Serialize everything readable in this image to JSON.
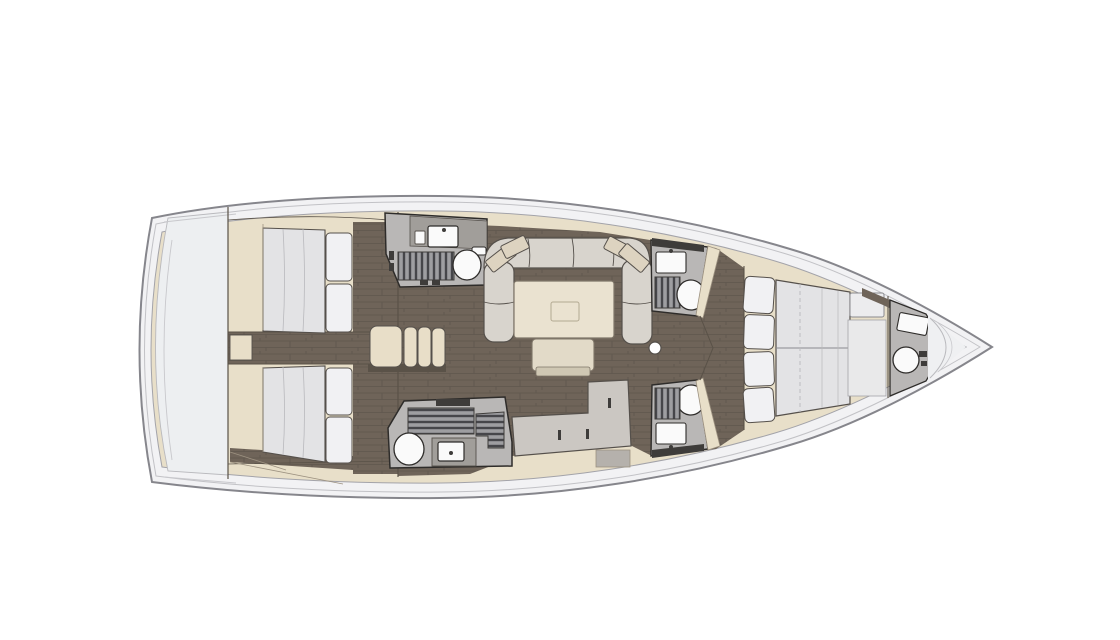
{
  "meta": {
    "description": "Sailing yacht interior layout floor plan, top-down view, bow pointing right, four cabins and five heads",
    "diagram_type": "yacht-floorplan",
    "orientation": "bow-right"
  },
  "colors": {
    "background": "#ffffff",
    "hull_band": "#f2f2f4",
    "hull_outline": "#86868c",
    "hull_mid_line": "#c2c2c6",
    "hull_inner_line": "#a3a3a9",
    "cabinetry_beige": "#e8dfc9",
    "cabinetry_edge": "#9c9180",
    "stern_platform": "#edeff1",
    "platform_edge": "#b9b9bd",
    "transom_line": "#c8c8cc",
    "floor_dark": "#6f6459",
    "floor_plank_line": "#5f564d",
    "wall_dark": "#5a5248",
    "mattress": "#e3e3e5",
    "pillow_white": "#f1f1f3",
    "furniture_outline": "#55504b",
    "bathroom_floor": "#b9b7b6",
    "bathroom_wall": "#2e2c2a",
    "bathroom_counter": "#a19e9a",
    "grate_fill": "#9e9ea1",
    "grate_slat": "#46464a",
    "fixture_white": "#fafafa",
    "dark_fixture": "#3e3c3a",
    "sofa": "#d8d4cd",
    "sofa_pillow": "#ddd3c0",
    "table": "#eae2d0",
    "table_edge": "#7e7568",
    "table_inner": "#b3a992",
    "bench": "#e2dac8",
    "bench_shadow": "#cfc7b3",
    "steps": "#e8dec8",
    "galley_counter": "#cbc7c2",
    "galley_front": "#b5b1ac",
    "bow_seat": "#ececee",
    "bow_panel": "#e9e9ea",
    "bow_wedge": "#eff0f2",
    "quilt_line": "#b9b9bd",
    "seam_line": "#8a8a8e"
  },
  "rooms": {
    "stern_platform": "Stern swim platform and transom",
    "aft_cabin_port": "Aft cabin port with double berth",
    "aft_cabin_starboard": "Aft cabin starboard with double berth",
    "head_aft_port": "Aft head port with sink, shower grate and toilet",
    "head_aft_starboard": "Aft head starboard with toilet, sink and shower grate",
    "companionway": "Companionway steps",
    "salon": "Salon with U-shaped settee, table and bench",
    "galley": "L-shaped galley counter",
    "head_fwd_port": "Forward head port with sink, shower grate and toilet",
    "head_fwd_starboard": "Forward head starboard with toilet, shower grate and sink",
    "fwd_cabin": "Forward owners cabin with island double berth and seat",
    "head_bow": "Bow head with sink and toilet",
    "mast_post": "Mast compression post"
  }
}
